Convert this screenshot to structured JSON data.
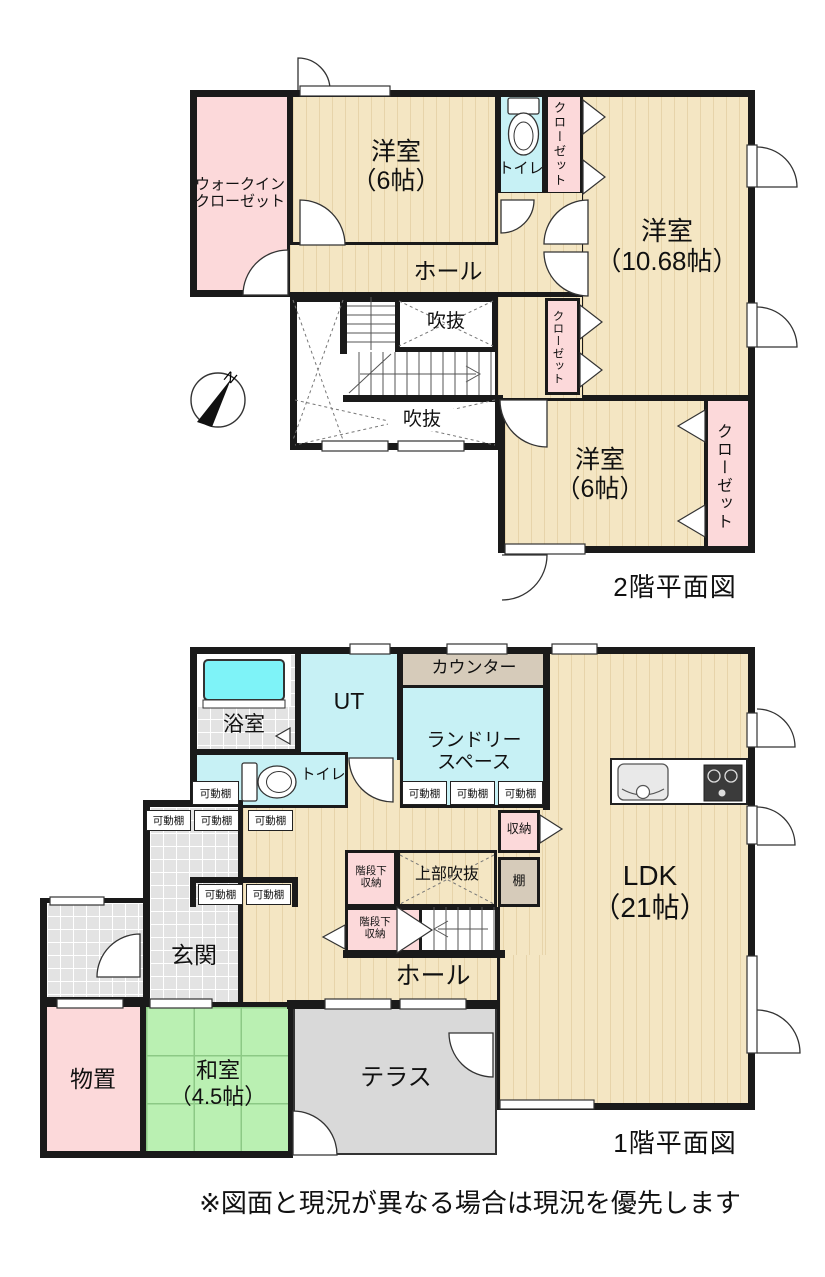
{
  "note": "※図面と現況が異なる場合は現況を優先します",
  "colors": {
    "wall": "#1a1a1a",
    "wood_floor": "#f4e6c3",
    "closet_pink": "#fcd9da",
    "wet_area_cyan": "#c7f1f5",
    "bathtub_cyan": "#7ef3f8",
    "tatami_green": "#baf0b2",
    "tile_gray": "#e3e3e3",
    "terrace_gray": "#d9d9d9",
    "counter_tan": "#d6cbba"
  },
  "floor2": {
    "title": "2階平面図",
    "wic": "ウォークイン\nクローゼット",
    "west_room_6_top": "洋室\n（6帖）",
    "toilet": "トイレ",
    "closet": "クローゼット",
    "west_room_1068": "洋室\n（10.68帖）",
    "hall": "ホール",
    "void": "吹抜",
    "west_room_6_se": "洋室\n（6帖）",
    "compass_north": "N"
  },
  "floor1": {
    "title": "1階平面図",
    "bath": "浴室",
    "ut": "UT",
    "counter": "カウンター",
    "laundry": "ランドリー\nスペース",
    "toilet": "トイレ",
    "movable_shelf": "可動棚",
    "entrance": "玄関",
    "storage": "収納",
    "shelf": "棚",
    "under_stair_storage": "階段下\n収納",
    "upper_void": "上部吹抜",
    "hall": "ホール",
    "ldk": "LDK\n（21帖）",
    "storage_room": "物置",
    "japanese_room": "和室\n（4.5帖）",
    "terrace": "テラス"
  }
}
